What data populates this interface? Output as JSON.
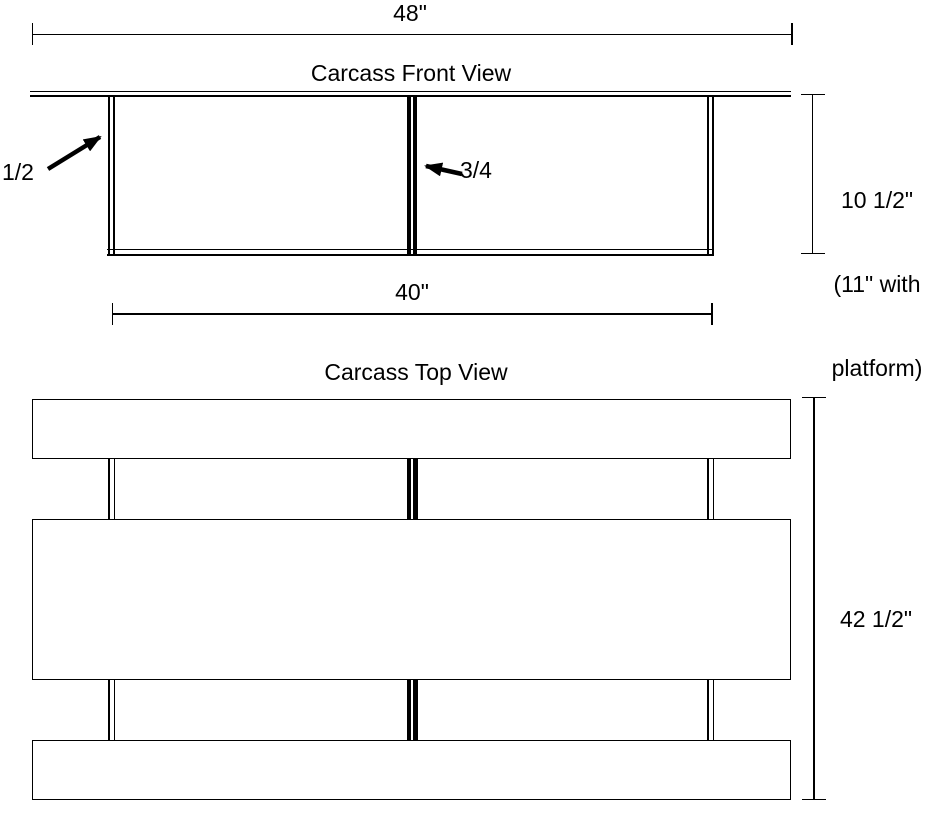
{
  "front_view": {
    "title": "Carcass Front View",
    "overall_width_label": "48\"",
    "inner_width_label": "40\"",
    "height_label_lines": [
      "10 1/2\"",
      "(11\" with",
      "platform)"
    ],
    "side_panel_thickness_label": "1/2",
    "center_divider_thickness_label": "3/4"
  },
  "top_view": {
    "title": "Carcass Top View",
    "overall_height_label": "42 1/2\""
  },
  "colors": {
    "line": "#000000",
    "background": "#ffffff"
  }
}
